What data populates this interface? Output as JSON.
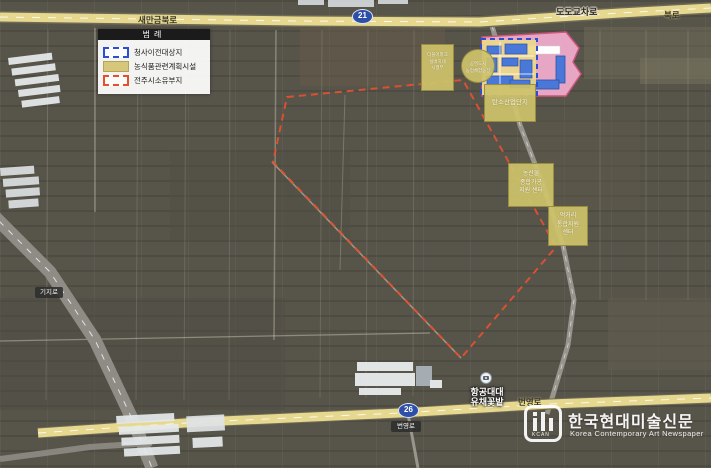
{
  "legend": {
    "title": "범례",
    "items": [
      {
        "label": "청사이전대상지",
        "swatch": "blue-dashed",
        "color": "#2b4fd0"
      },
      {
        "label": "농식품관련계획시설",
        "swatch": "yellow-fill",
        "color": "#d6c77b"
      },
      {
        "label": "전주시소유부지",
        "swatch": "red-dashed",
        "color": "#e2502e"
      }
    ]
  },
  "roads": {
    "top": {
      "label": "새만금북로",
      "route": "21"
    },
    "top_right": {
      "intersection": "도도교차로",
      "label": "북로"
    },
    "bottom": {
      "label": "번영로",
      "route": "26",
      "badge": "번영로"
    },
    "left": {
      "badge": "기지로"
    }
  },
  "sites": {
    "silver_block": {
      "lines": [
        "더블어파크",
        "실버지네",
        "시행부"
      ]
    },
    "farm_circle": {
      "lines": [
        "공영도시",
        "농업체험농장"
      ]
    },
    "industry_box": {
      "label": "탄소산업단지"
    },
    "processing_box": {
      "lines": [
        "농산물",
        "종합가공",
        "지원 센터"
      ]
    },
    "food_box": {
      "lines": [
        "먹거리",
        "통합지원",
        "센터"
      ]
    }
  },
  "poi": {
    "lines": [
      "항공대대",
      "유채꽃밭"
    ]
  },
  "watermark": {
    "initials": "KCAN",
    "title": "한국현대미술신문",
    "subtitle": "Korea Contemporary Art Newspaper"
  },
  "colors": {
    "field_base": "#57544a",
    "road_yellow": "#e6d88e",
    "route_shield_blue": "#2d4fa8",
    "site_yellow": "#cec26b",
    "plan_pink": "#efaccb",
    "boundary_red": "#e0512f",
    "boundary_blue": "#2b4fd0"
  }
}
